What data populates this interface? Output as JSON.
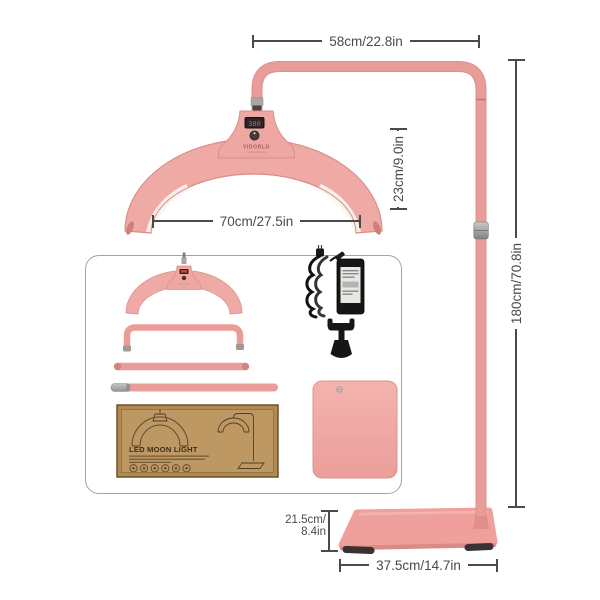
{
  "product": {
    "name": "led-moon-light-floor-lamp",
    "brand": "VIDORLO",
    "led_display_value": "380"
  },
  "annotations": {
    "arm_width": "58cm/22.8in",
    "lamp_width": "70cm/27.5in",
    "lamp_height": "23cm/9.0in",
    "stand_height": "180cm/70.8in",
    "base_depth": [
      "21.5cm/",
      "8.4in"
    ],
    "base_width": "37.5cm/14.7in"
  },
  "package": {
    "title": "LED MOON LIGHT",
    "certification_icons": [
      "cert-icon-1",
      "cert-icon-2",
      "cert-icon-3",
      "cert-icon-4",
      "cert-icon-5",
      "cert-icon-6"
    ]
  },
  "accessories": [
    "lamp-head",
    "curved-arm",
    "upper-pole-tube",
    "lower-pole-tube",
    "power-adapter",
    "phone-holder-clamp",
    "base-plate",
    "packaging-box"
  ],
  "colors": {
    "product_pink": "#ea9c99",
    "product_pink_light": "#f0aaa6",
    "product_pink_dark": "#d98e8a",
    "metal_silver": "#b0b0b0",
    "dimension_ink": "#4a4a4a",
    "carton_kraft": "#b58f58",
    "led_digit_red": "#f4512e"
  }
}
